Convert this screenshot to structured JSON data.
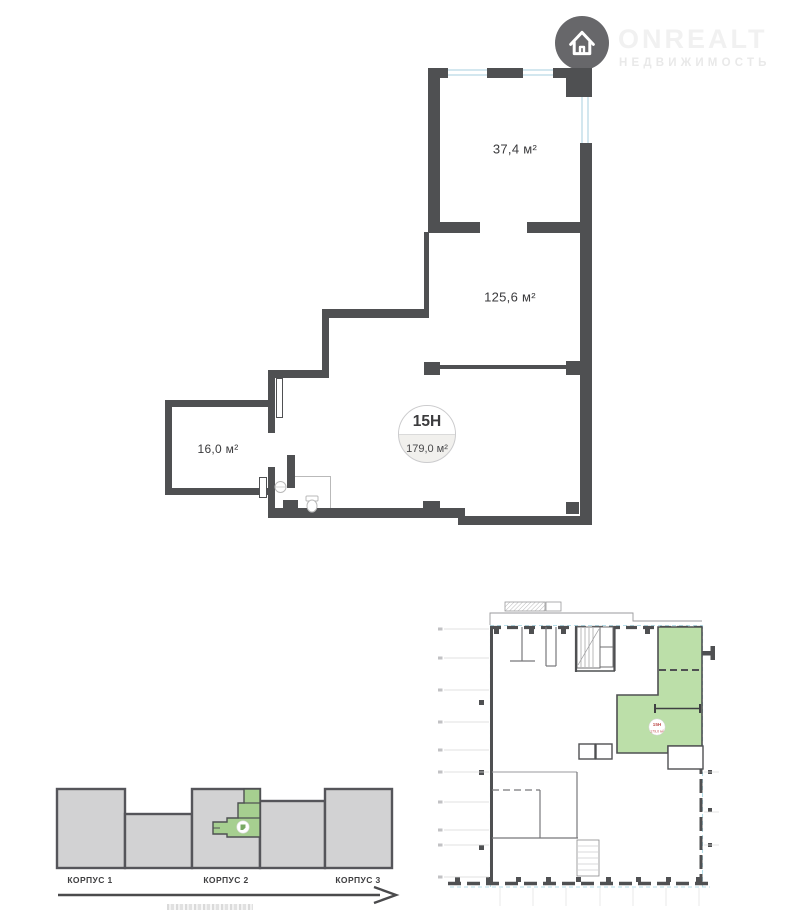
{
  "logo": {
    "brand": "ONREALT",
    "subtitle": "НЕДВИЖИМОСТЬ"
  },
  "plan": {
    "unit_badge": {
      "number": "15Н",
      "area": "179,0 м²"
    },
    "rooms": [
      {
        "name": "room-upper",
        "area": "37,4 м²"
      },
      {
        "name": "room-middle",
        "area": "125,6 м²"
      },
      {
        "name": "room-left",
        "area": "16,0 м²"
      }
    ]
  },
  "key_plan": {
    "unit_number": "15Н",
    "unit_area": "179,0 м²"
  },
  "strip_diagram": {
    "blocks": [
      {
        "label": "КОРПУС 1"
      },
      {
        "label": "КОРПУС 2"
      },
      {
        "label": "КОРПУС 3"
      }
    ]
  },
  "colors": {
    "wall": "#4f5052",
    "window_line": "#d3e7ef",
    "unit_green_keyplan": "#bcdfa9",
    "unit_green_strip": "#a6cf90",
    "block_gray": "#d2d2d3",
    "keyplan_dashed_blue": "#b5dde8",
    "keyplan_unit_text_red": "#bf4f4e"
  }
}
